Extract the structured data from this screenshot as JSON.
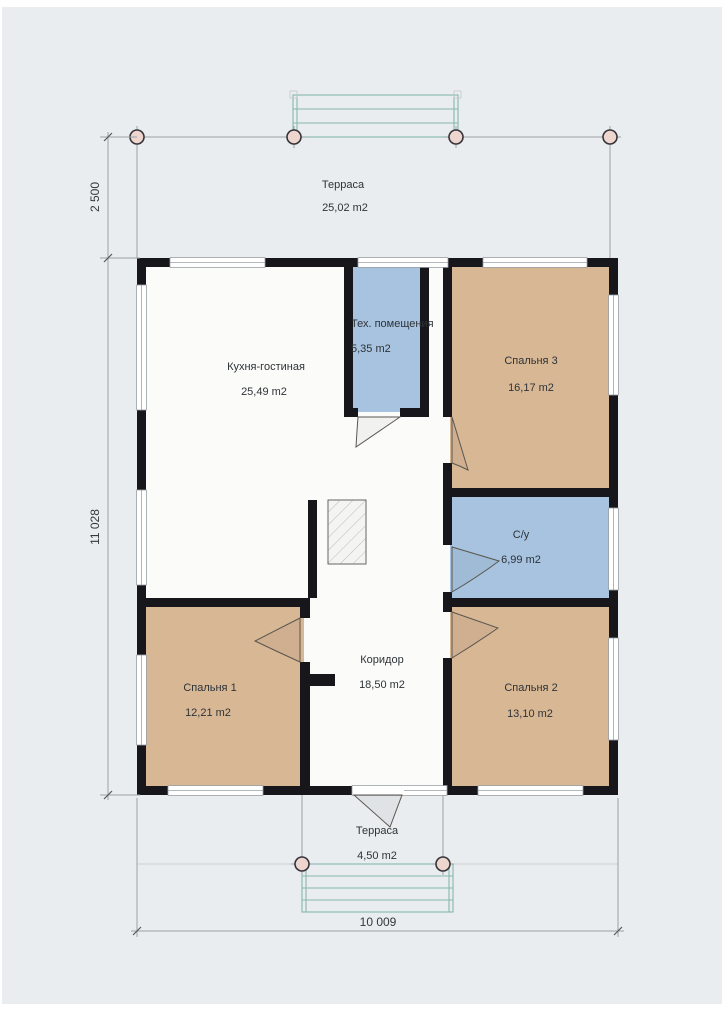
{
  "plan": {
    "rooms": [
      {
        "id": "terrace-top",
        "name": "Терраса",
        "area": "25,02 m2"
      },
      {
        "id": "kitchen-living",
        "name": "Кухня-гостиная",
        "area": "25,49 m2"
      },
      {
        "id": "tech-room",
        "name": "Тех. помещения",
        "area": "5,35 m2"
      },
      {
        "id": "bedroom-3",
        "name": "Спальня 3",
        "area": "16,17 m2"
      },
      {
        "id": "bathroom",
        "name": "С/у",
        "area": "6,99 m2"
      },
      {
        "id": "corridor",
        "name": "Коридор",
        "area": "18,50 m2"
      },
      {
        "id": "bedroom-1",
        "name": "Спальня 1",
        "area": "12,21 m2"
      },
      {
        "id": "bedroom-2",
        "name": "Спальня 2",
        "area": "13,10 m2"
      },
      {
        "id": "terrace-bottom",
        "name": "Терраса",
        "area": "4,50 m2"
      }
    ],
    "dimensions": {
      "left_top": "2 500",
      "left_main": "11 028",
      "bottom": "10 009"
    },
    "colors": {
      "wall": "#17171b",
      "bedroom_fill": "#d8b795",
      "wet_fill": "#a7c3df",
      "floor_fill": "#fbfbf9",
      "canvas_bg": "#eaedef",
      "stairs_line": "#85b7ae",
      "dimension_line": "#9aa1a6",
      "column_fill": "#eed6cf",
      "label_text": "#2e3338"
    }
  }
}
